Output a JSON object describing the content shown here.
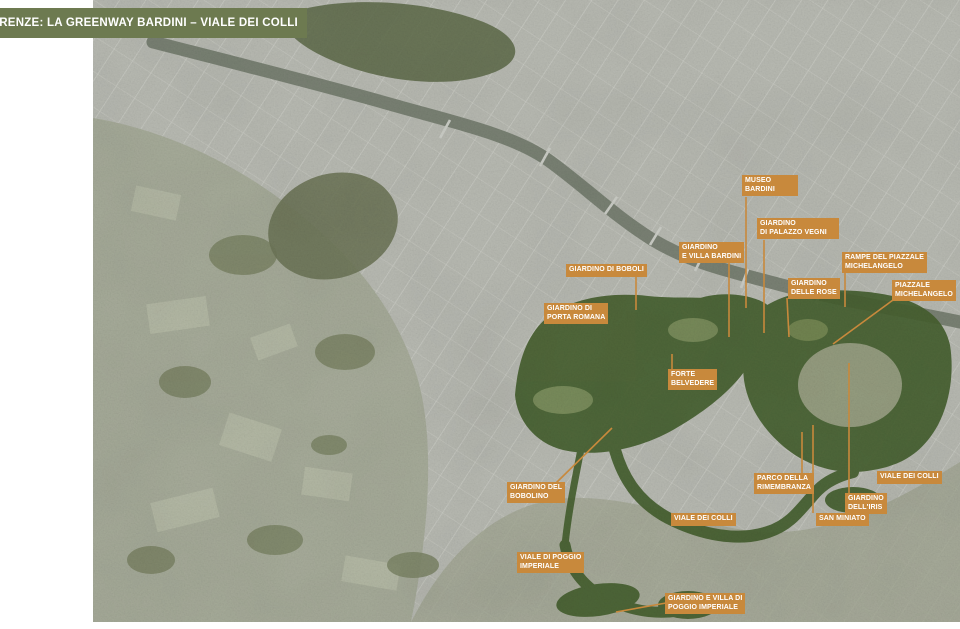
{
  "header": {
    "title": "PIANTA DI FIRENZE: LA GREENWAY BARDINI – VIALE DEI COLLI"
  },
  "colors": {
    "banner_green": "#6d7a50",
    "label_orange": "#c8893c",
    "greenway_green": "#46602f",
    "river": "#7a8274",
    "rural": "#a7ac9a",
    "city": "#b9bbb3"
  },
  "map": {
    "labels": [
      {
        "id": "museo-bardini",
        "text": "MUSEO\nBARDINI",
        "x": 742,
        "y": 175,
        "w": 56
      },
      {
        "id": "giardino-di-palazzo-vegni",
        "text": "GIARDINO\nDI PALAZZO VEGNI",
        "x": 757,
        "y": 218,
        "w": 82
      },
      {
        "id": "giardino-e-villa-bardini",
        "text": "GIARDINO\nE VILLA BARDINI",
        "x": 679,
        "y": 242,
        "w": 0
      },
      {
        "id": "giardino-di-boboli",
        "text": "GIARDINO DI BOBOLI",
        "x": 566,
        "y": 264,
        "w": 0
      },
      {
        "id": "rampe-del-piazzale-michelangelo",
        "text": "RAMPE DEL PIAZZALE\nMICHELANGELO",
        "x": 842,
        "y": 252,
        "w": 0
      },
      {
        "id": "giardino-delle-rose",
        "text": "GIARDINO\nDELLE ROSE",
        "x": 788,
        "y": 278,
        "w": 0
      },
      {
        "id": "piazzale-michelangelo",
        "text": "PIAZZALE\nMICHELANGELO",
        "x": 892,
        "y": 280,
        "w": 0
      },
      {
        "id": "giardino-di-porta-romana",
        "text": "GIARDINO DI\nPORTA ROMANA",
        "x": 544,
        "y": 303,
        "w": 0
      },
      {
        "id": "forte-belvedere",
        "text": "FORTE\nBELVEDERE",
        "x": 668,
        "y": 369,
        "w": 0
      },
      {
        "id": "giardino-del-bobolino",
        "text": "GIARDINO DEL\nBOBOLINO",
        "x": 507,
        "y": 482,
        "w": 57
      },
      {
        "id": "viale-dei-colli-center",
        "text": "VIALE DEI COLLI",
        "x": 671,
        "y": 513,
        "w": 0
      },
      {
        "id": "parco-della-rimembranza",
        "text": "PARCO DELLA\nRIMEMBRANZA",
        "x": 754,
        "y": 473,
        "w": 0
      },
      {
        "id": "viale-dei-colli-east",
        "text": "VIALE DEI COLLI",
        "x": 877,
        "y": 471,
        "w": 0
      },
      {
        "id": "giardino-dell-iris",
        "text": "GIARDINO\nDELL'IRIS",
        "x": 845,
        "y": 493,
        "w": 0
      },
      {
        "id": "san-miniato",
        "text": "SAN MINIATO",
        "x": 816,
        "y": 513,
        "w": 0
      },
      {
        "id": "viale-di-poggio-imperiale",
        "text": "VIALE DI POGGIO\nIMPERIALE",
        "x": 517,
        "y": 552,
        "w": 55
      },
      {
        "id": "giardino-e-villa-di-poggio-imperiale",
        "text": "GIARDINO E VILLA DI\nPOGGIO IMPERIALE",
        "x": 665,
        "y": 593,
        "w": 0
      }
    ],
    "leaders": [
      {
        "x1": 746,
        "y1": 197,
        "x2": 746,
        "y2": 308
      },
      {
        "x1": 764,
        "y1": 240,
        "x2": 764,
        "y2": 333
      },
      {
        "x1": 729,
        "y1": 263,
        "x2": 729,
        "y2": 337
      },
      {
        "x1": 636,
        "y1": 277,
        "x2": 636,
        "y2": 310
      },
      {
        "x1": 845,
        "y1": 272,
        "x2": 845,
        "y2": 307
      },
      {
        "x1": 787,
        "y1": 298,
        "x2": 789,
        "y2": 337
      },
      {
        "x1": 893,
        "y1": 300,
        "x2": 833,
        "y2": 344
      },
      {
        "x1": 672,
        "y1": 369,
        "x2": 672,
        "y2": 354
      },
      {
        "x1": 556,
        "y1": 483,
        "x2": 612,
        "y2": 428
      },
      {
        "x1": 802,
        "y1": 432,
        "x2": 802,
        "y2": 473
      },
      {
        "x1": 849,
        "y1": 363,
        "x2": 849,
        "y2": 493
      },
      {
        "x1": 813,
        "y1": 425,
        "x2": 813,
        "y2": 513
      },
      {
        "x1": 666,
        "y1": 603,
        "x2": 616,
        "y2": 612
      }
    ]
  }
}
